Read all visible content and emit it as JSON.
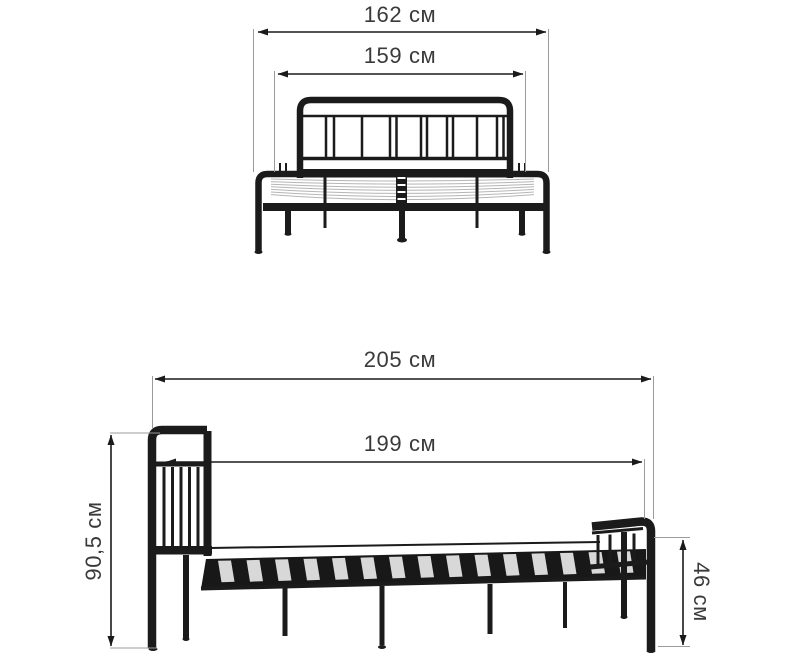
{
  "diagram": {
    "unit": "см",
    "front_view": {
      "overall_width": "162 см",
      "inner_width": "159 см"
    },
    "side_view": {
      "overall_length": "205 см",
      "inner_length": "199 см",
      "headboard_height": "90,5 см",
      "footboard_height": "46 см"
    }
  },
  "colors": {
    "background": "#ffffff",
    "line_art": "#1b1b1b",
    "dimension_line": "#1a1a1a",
    "extension_line": "#9b9b9b",
    "label_text": "#3a3a3a",
    "slat_light": "#d8d8d8",
    "mesh_line": "#b5b5b5"
  }
}
